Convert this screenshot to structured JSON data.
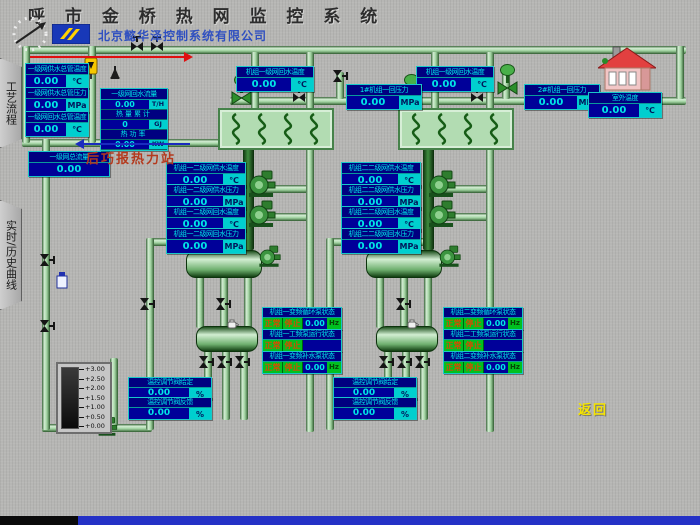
{
  "colors": {
    "box_navy": "#000080",
    "box_cyan": "#00e6e6",
    "unit_cell_cyan": "#00cfcf",
    "status_green": "#00c020",
    "status_text_orange": "#d84a00",
    "pipe_green": "#9ccf9c",
    "station_red": "#b43a1e",
    "company_blue": "#3050c0",
    "back_yellow": "#f5e400",
    "bottom_bar_blue": "#2431c6"
  },
  "icons": {
    "clock": "clock-dashed-circle-arrow-icon",
    "logo": "company-logo",
    "house": "house-outdoor-icon",
    "valves": "valve-icon",
    "pumps": "pump-icon"
  },
  "header": {
    "title": "呼 市 金 桥 热 网 监 控 系 统",
    "company": "北京懿华泽控制系统有限公司",
    "station": "后巧报热力站",
    "back_label": "返回"
  },
  "sidebar": {
    "tabs": [
      {
        "label": "工艺流程"
      },
      {
        "label": "实时/历史曲线"
      }
    ]
  },
  "measure_boxes": [
    {
      "name": "primary-supply-main-temp",
      "title": "一级网供水总管温度",
      "value": "0.00",
      "unit": "℃"
    },
    {
      "name": "primary-supply-main-press",
      "title": "一级网供水总管压力",
      "value": "0.00",
      "unit": "MPa"
    },
    {
      "name": "primary-return-main-temp",
      "title": "一级网回水总管温度",
      "value": "0.00",
      "unit": "℃"
    },
    {
      "name": "primary-total-flow",
      "title": "一级网总流量",
      "value": "0.00",
      "unit": ""
    },
    {
      "name": "unit1-primary-return-temp",
      "title": "机组一级网回水温度",
      "value": "0.00",
      "unit": "℃"
    },
    {
      "name": "unit2-primary-return-temp",
      "title": "机组一级网回水温度",
      "value": "0.00",
      "unit": "℃"
    },
    {
      "name": "unit1-primary-return-press",
      "title": "1#机组一回压力",
      "value": "0.00",
      "unit": "MPa"
    },
    {
      "name": "unit2-primary-return-press",
      "title": "2#机组一回压力",
      "value": "0.00",
      "unit": "MPa"
    },
    {
      "name": "outdoor-temp",
      "title": "室外温度",
      "value": "0.00",
      "unit": "℃"
    },
    {
      "name": "unit1-secondary-supply-temp",
      "title": "机组一二级网供水温度",
      "value": "0.00",
      "unit": "℃"
    },
    {
      "name": "unit1-secondary-supply-press",
      "title": "机组一二级网供水压力",
      "value": "0.00",
      "unit": "MPa"
    },
    {
      "name": "unit1-secondary-return-temp",
      "title": "机组一二级网回水温度",
      "value": "0.00",
      "unit": "℃"
    },
    {
      "name": "unit1-secondary-return-press",
      "title": "机组一二级网回水压力",
      "value": "0.00",
      "unit": "MPa"
    },
    {
      "name": "unit2-secondary-supply-temp",
      "title": "机组二二级网供水温度",
      "value": "0.00",
      "unit": "℃"
    },
    {
      "name": "unit2-secondary-supply-press",
      "title": "机组二二级网供水压力",
      "value": "0.00",
      "unit": "MPa"
    },
    {
      "name": "unit2-secondary-return-temp",
      "title": "机组二二级网回水温度",
      "value": "0.00",
      "unit": "℃"
    },
    {
      "name": "unit2-secondary-return-press",
      "title": "机组二二级网回水压力",
      "value": "0.00",
      "unit": "MPa"
    },
    {
      "name": "unit1-valve-setpoint",
      "title": "温控调节阀给定",
      "value": "0.00",
      "unit": "%"
    },
    {
      "name": "unit1-valve-feedback",
      "title": "温控调节阀反馈",
      "value": "0.00",
      "unit": "%"
    },
    {
      "name": "unit2-valve-setpoint",
      "title": "温控调节阀给定",
      "value": "0.00",
      "unit": "%"
    },
    {
      "name": "unit2-valve-feedback",
      "title": "温控调节阀反馈",
      "value": "0.00",
      "unit": "%"
    }
  ],
  "flow_box": {
    "title": "一级网回水流量",
    "rows": [
      {
        "kind": "value",
        "value": "0.00",
        "unit": "T/H"
      },
      {
        "kind": "label",
        "label": "热量累计"
      },
      {
        "kind": "value",
        "value": "0",
        "unit": "GJ"
      },
      {
        "kind": "label",
        "label": "热功率"
      },
      {
        "kind": "value",
        "value": "0.00",
        "unit": "KW"
      }
    ]
  },
  "status_boxes": [
    {
      "name": "unit1-vfd-circ-pump-status",
      "title": "机组一变频循环泵状态",
      "cells": [
        {
          "text": "正常",
          "type": "ok"
        },
        {
          "text": "停止",
          "type": "ok"
        },
        {
          "text": "0.00",
          "type": "val"
        },
        {
          "text": "Hz",
          "type": "unit"
        }
      ]
    },
    {
      "name": "unit1-fixed-pump-status",
      "title": "机组一工频泵运行状态",
      "cells": [
        {
          "text": "正常",
          "type": "ok"
        },
        {
          "text": "停止",
          "type": "ok"
        }
      ]
    },
    {
      "name": "unit1-vfd-makeup-pump-status",
      "title": "机组一变频补水泵状态",
      "cells": [
        {
          "text": "正常",
          "type": "ok"
        },
        {
          "text": "停止",
          "type": "ok"
        },
        {
          "text": "0.00",
          "type": "val"
        },
        {
          "text": "Hz",
          "type": "unit"
        }
      ]
    },
    {
      "name": "unit2-vfd-circ-pump-status",
      "title": "机组二变频循环泵状态",
      "cells": [
        {
          "text": "正常",
          "type": "ok"
        },
        {
          "text": "停止",
          "type": "ok"
        },
        {
          "text": "0.00",
          "type": "val"
        },
        {
          "text": "Hz",
          "type": "unit"
        }
      ]
    },
    {
      "name": "unit2-fixed-pump-status",
      "title": "机组二工频泵运行状态",
      "cells": [
        {
          "text": "正常",
          "type": "ok"
        },
        {
          "text": "停止",
          "type": "ok"
        }
      ]
    },
    {
      "name": "unit2-vfd-makeup-pump-status",
      "title": "机组二变频补水泵状态",
      "cells": [
        {
          "text": "正常",
          "type": "ok"
        },
        {
          "text": "停止",
          "type": "ok"
        },
        {
          "text": "0.00",
          "type": "val"
        },
        {
          "text": "Hz",
          "type": "unit"
        }
      ]
    }
  ],
  "tank": {
    "scale": [
      "+3.00",
      "+2.50",
      "+2.00",
      "+1.50",
      "+1.00",
      "+0.50",
      "+0.00"
    ]
  }
}
